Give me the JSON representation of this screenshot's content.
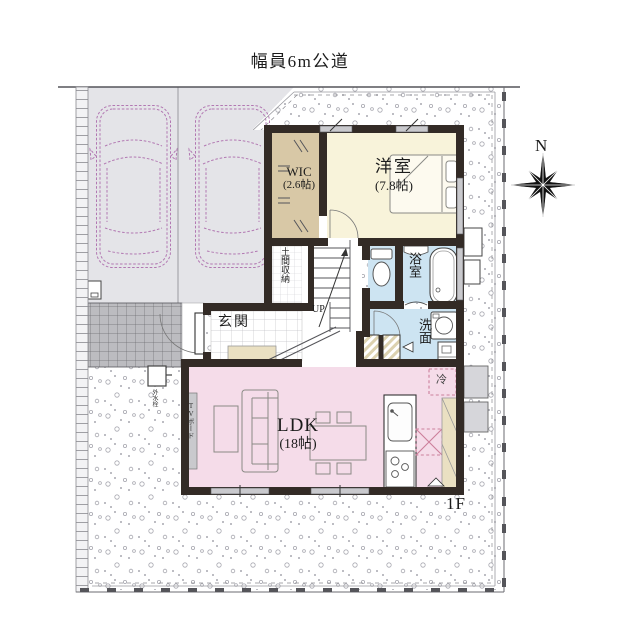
{
  "road": {
    "label": "幅員6m公道"
  },
  "compass": {
    "north": "N"
  },
  "floor": {
    "label": "1F"
  },
  "rooms": {
    "wic": {
      "name": "WIC",
      "size": "(2.6帖)"
    },
    "western_room": {
      "name": "洋室",
      "size": "(7.8帖)"
    },
    "bathroom": {
      "name": "浴室"
    },
    "washroom": {
      "name": "洗面"
    },
    "entrance": {
      "name": "玄関"
    },
    "doma_storage": {
      "name": "土間収納"
    },
    "stairs": {
      "direction": "UP"
    },
    "ldk": {
      "name": "LDK",
      "size": "(18帖)"
    }
  },
  "fixtures": {
    "tv_board": "TVボード",
    "outdoor_faucet": "外水栓",
    "refrigerator": "冷"
  },
  "colors": {
    "wall": "#332b26",
    "wic": "#d8c8a6",
    "western_room": "#f8f3da",
    "wet_rooms": "#cde4f2",
    "ldk": "#f5dce9",
    "parking": "#e4e4e8",
    "approach_tile": "#bcbcc0",
    "cupboard": "#eae0c2",
    "window_bar": "#c9c9cd",
    "accent_dashed": "#cc7f9b",
    "car_outline": "#b278b2"
  }
}
